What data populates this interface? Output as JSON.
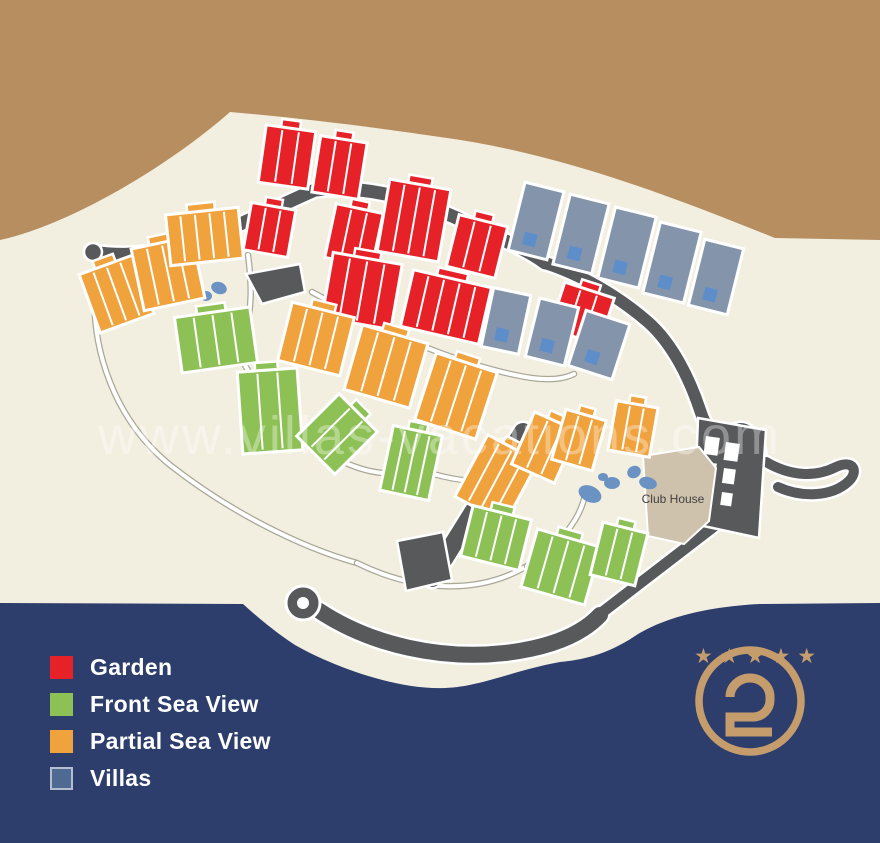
{
  "legend": {
    "items": [
      {
        "label": "Garden",
        "color": "#e62128"
      },
      {
        "label": "Front Sea View",
        "color": "#8dc156"
      },
      {
        "label": "Partial Sea View",
        "color": "#f0a23c"
      },
      {
        "label": "Villas",
        "color": "#4e6a93",
        "border": "#b3bfd1"
      }
    ]
  },
  "map": {
    "club_house_label": "Club House",
    "watermark": "www.villas-vacations.com"
  },
  "logo": {
    "stars_text": "★★★★★",
    "color": "#c59d6d"
  },
  "scene": {
    "colors": {
      "hillside": "#b78e60",
      "land": "#f2efe1",
      "footer": "#2d3e6d",
      "road": "#58595b",
      "path_edge": "#aaa797",
      "garden": "#e62128",
      "partial": "#f0a23c",
      "front": "#8dc156",
      "villa": "#8494ab",
      "pool": "#5e8ec9",
      "water": "#6a93c3",
      "clubhouse": "#cfc2ac"
    },
    "land": "M0,240 C70,225 170,165 230,112 C300,118 380,128 440,137 C560,153 670,196 775,238 L880,240 L880,603 L760,604 C700,607 660,620 635,636 C605,656 580,660 560,662 C515,670 480,687 445,688 C395,690 330,665 295,645 C275,632 255,615 243,604 L0,603 Z",
    "thin_paths": [
      "M312,292 C380,330 450,362 520,376 C545,381 562,380 574,374",
      "M95,282 C90,350 115,420 170,465 C230,512 300,547 357,563",
      "M230,336 C255,392 292,432 332,456 C362,473 392,478 418,469",
      "M357,563 C420,594 482,593 527,566",
      "M527,566 C560,545 580,520 585,495",
      "M418,469 C448,480 480,484 510,480",
      "M248,255 C252,285 252,310 245,332"
    ],
    "roads": [
      {
        "d": "M93,252 C130,258 165,252 200,240 C240,226 280,205 315,190 C335,182 345,172 350,158",
        "w": 13
      },
      {
        "d": "M350,158 C352,148 345,145 341,152",
        "w": 9
      },
      {
        "d": "M315,190 C365,184 420,200 465,222 C505,241 528,250 545,263",
        "w": 13
      },
      {
        "d": "M545,263 C580,274 618,296 648,322 C673,344 690,380 700,410 C706,430 718,442 732,448",
        "w": 12
      },
      {
        "d": "M246,274 L300,264 L305,292 L262,304 Z",
        "fill": 1
      },
      {
        "d": "M600,614 L756,494",
        "w": 11
      },
      {
        "d": "M742,478 L756,494",
        "w": 9
      },
      {
        "d": "M318,610 C372,646 442,660 505,653 C556,647 584,632 600,615",
        "w": 16
      },
      {
        "d": "M432,578 L523,432",
        "w": 18
      },
      {
        "d": "M397,541 L443,532 L452,580 L406,591 Z",
        "fill": 1
      },
      {
        "d": "M766,462 C792,477 816,477 836,467 C853,459 859,471 849,481 C831,498 800,497 778,487",
        "w": 10
      }
    ],
    "blobs": [
      [
        93,
        252,
        9
      ],
      [
        349,
        155,
        7
      ]
    ],
    "roundabout": [
      303,
      603,
      17,
      6
    ],
    "loop": [
      744,
      450,
      15,
      22,
      -18,
      11
    ],
    "courts": {
      "body": "M698,418 L766,430 L759,538 L694,524 Z",
      "cells": [
        [
          706,
          436,
          14,
          18,
          8
        ],
        [
          726,
          442,
          14,
          18,
          8
        ],
        [
          705,
          462,
          12,
          15,
          8
        ],
        [
          724,
          468,
          12,
          15,
          8
        ],
        [
          703,
          487,
          11,
          13,
          8
        ],
        [
          722,
          492,
          11,
          13,
          8
        ]
      ]
    },
    "clubhouse": "M643,456 L699,447 L716,468 L709,521 L684,544 L648,536 Z",
    "ponds": [
      [
        190,
        291,
        11,
        7,
        -15
      ],
      [
        206,
        296,
        6,
        5,
        0
      ],
      [
        219,
        288,
        8,
        6,
        20
      ],
      [
        590,
        494,
        12,
        8,
        25
      ],
      [
        612,
        483,
        8,
        6,
        0
      ],
      [
        634,
        472,
        7,
        6,
        -30
      ],
      [
        648,
        483,
        9,
        6,
        15
      ],
      [
        603,
        477,
        5,
        4,
        0
      ]
    ],
    "clusters": {
      "garden": [
        [
          262,
          128,
          50,
          58,
          8,
          2
        ],
        [
          316,
          139,
          47,
          57,
          9,
          2
        ],
        [
          247,
          206,
          45,
          48,
          10,
          2
        ],
        [
          330,
          208,
          48,
          55,
          12,
          2
        ],
        [
          383,
          184,
          62,
          73,
          10,
          3
        ],
        [
          452,
          220,
          50,
          53,
          14,
          2
        ],
        [
          327,
          258,
          70,
          66,
          10,
          3
        ],
        [
          406,
          278,
          80,
          58,
          13,
          4
        ],
        [
          556,
          289,
          52,
          49,
          18,
          2
        ]
      ],
      "partial": [
        [
          88,
          263,
          57,
          62,
          -20,
          3
        ],
        [
          137,
          242,
          62,
          63,
          -12,
          3
        ],
        [
          168,
          211,
          73,
          51,
          -6,
          4
        ],
        [
          284,
          309,
          64,
          60,
          14,
          3
        ],
        [
          352,
          333,
          68,
          67,
          16,
          3
        ],
        [
          424,
          361,
          64,
          70,
          18,
          3
        ],
        [
          468,
          444,
          57,
          70,
          28,
          3
        ],
        [
          521,
          419,
          47,
          57,
          24,
          2
        ],
        [
          558,
          414,
          42,
          52,
          16,
          2
        ],
        [
          612,
          404,
          42,
          50,
          10,
          2
        ]
      ],
      "front": [
        [
          178,
          312,
          76,
          56,
          -8,
          3
        ],
        [
          240,
          370,
          60,
          82,
          -4,
          2
        ],
        [
          310,
          404,
          54,
          60,
          45,
          2
        ],
        [
          386,
          430,
          50,
          66,
          12,
          3
        ],
        [
          466,
          512,
          60,
          52,
          14,
          3
        ],
        [
          528,
          537,
          66,
          60,
          16,
          3
        ],
        [
          596,
          527,
          46,
          54,
          14,
          2
        ]
      ]
    },
    "villas": [
      [
        516,
        186,
        40,
        70,
        14
      ],
      [
        561,
        198,
        40,
        72,
        14
      ],
      [
        606,
        211,
        42,
        73,
        14
      ],
      [
        651,
        226,
        42,
        73,
        14
      ],
      [
        696,
        243,
        40,
        68,
        14
      ],
      [
        487,
        291,
        38,
        60,
        12
      ],
      [
        532,
        302,
        40,
        60,
        14
      ],
      [
        576,
        316,
        46,
        58,
        18
      ]
    ]
  }
}
